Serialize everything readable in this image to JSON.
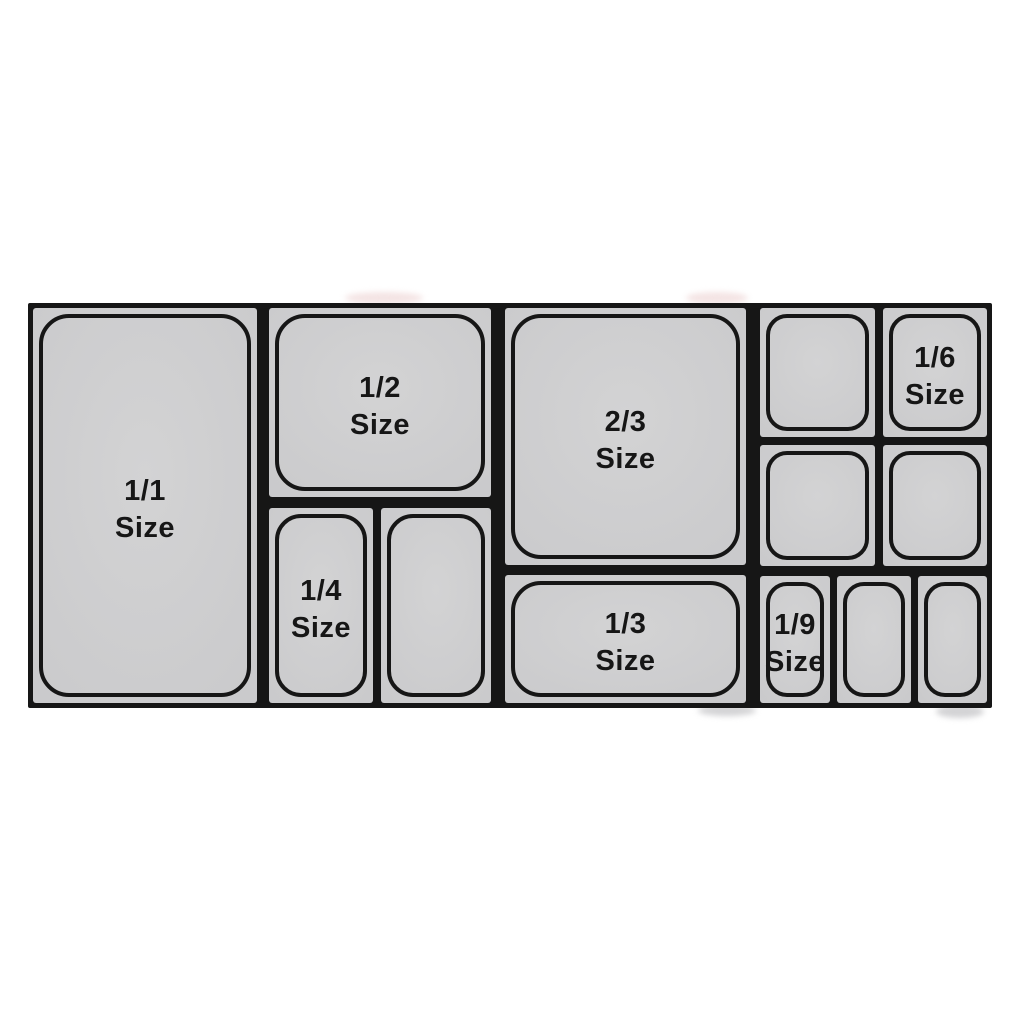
{
  "diagram": {
    "description": "Food pan size layout diagram",
    "colors": {
      "background": "#ffffff",
      "panel_fill": "#c9c9cb",
      "line": "#161616",
      "text": "#161616"
    },
    "panels": [
      {
        "id": "pan-1-1",
        "label": [
          "1/1",
          "Size"
        ]
      },
      {
        "id": "pan-1-2",
        "label": [
          "1/2",
          "Size"
        ]
      },
      {
        "id": "pan-1-4",
        "label": [
          "1/4",
          "Size"
        ]
      },
      {
        "id": "pan-1-4-unlabeled",
        "label": [
          "",
          ""
        ]
      },
      {
        "id": "pan-2-3",
        "label": [
          "2/3",
          "Size"
        ]
      },
      {
        "id": "pan-1-3",
        "label": [
          "1/3",
          "Size"
        ]
      },
      {
        "id": "pan-1-6-unlabeled-top",
        "label": [
          "",
          ""
        ]
      },
      {
        "id": "pan-1-6",
        "label": [
          "1/6",
          "Size"
        ]
      },
      {
        "id": "pan-1-6-unlabeled-left",
        "label": [
          "",
          ""
        ]
      },
      {
        "id": "pan-1-6-unlabeled-right",
        "label": [
          "",
          ""
        ]
      },
      {
        "id": "pan-1-9",
        "label": [
          "1/9",
          "Size"
        ]
      },
      {
        "id": "pan-1-9-unlabeled-1",
        "label": [
          "",
          ""
        ]
      },
      {
        "id": "pan-1-9-unlabeled-2",
        "label": [
          "",
          ""
        ]
      }
    ]
  }
}
